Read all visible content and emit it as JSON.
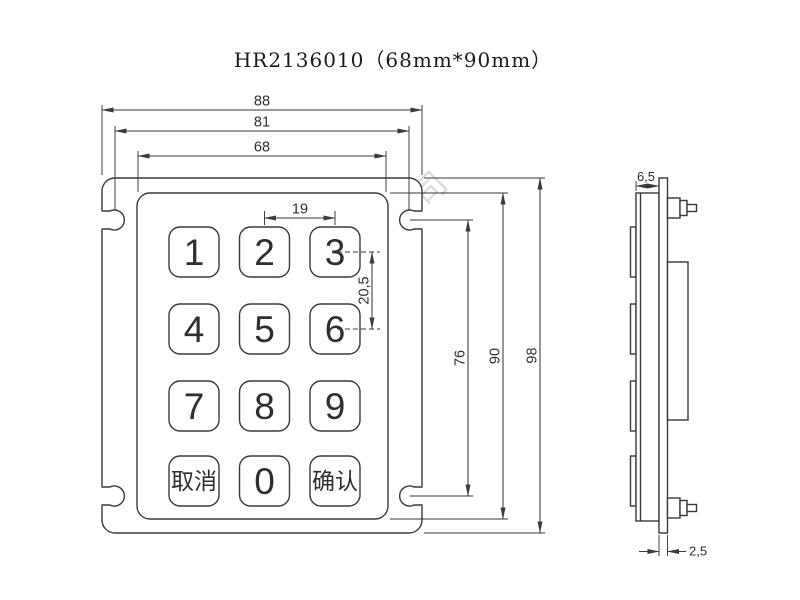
{
  "title": "HR2136010（68mm*90mm）",
  "watermark": "深圳市汇融电子设备有限公司",
  "front": {
    "keys": [
      "1",
      "2",
      "3",
      "4",
      "5",
      "6",
      "7",
      "8",
      "9",
      "取消",
      "0",
      "确认"
    ],
    "dims": {
      "overall_width": "88",
      "slot_span_width": "81",
      "panel_width": "68",
      "key_pitch_horizontal": "19",
      "key_pitch_vertical": "20,5",
      "slot_span_height": "76",
      "panel_height": "90",
      "overall_height": "98"
    }
  },
  "side": {
    "dims": {
      "depth": "6,5",
      "plate_thickness": "2,5"
    }
  },
  "colors": {
    "line": "#3a3a3a",
    "background": "#ffffff",
    "watermark": "#d7d7d7"
  }
}
